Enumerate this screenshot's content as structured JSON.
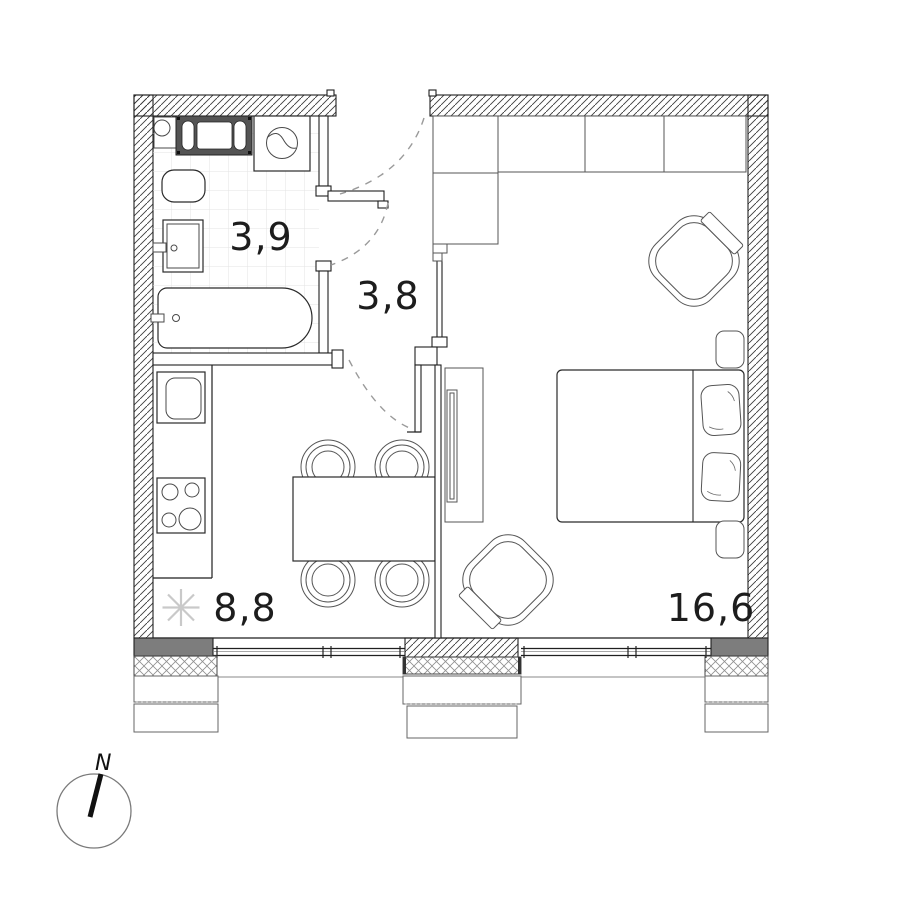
{
  "plan": {
    "rooms": [
      {
        "id": "bathroom",
        "area_label": "3,9"
      },
      {
        "id": "hallway",
        "area_label": "3,8"
      },
      {
        "id": "kitchen",
        "area_label": "8,8"
      },
      {
        "id": "living-room",
        "area_label": "16,6"
      }
    ],
    "compass": {
      "north_label": "N"
    },
    "colors": {
      "pier_fill": "#7d7d7d",
      "appliance_frame": "#545454",
      "snowflake": "#c9c9c9",
      "tile_line": "#e3e3e3",
      "dash_line": "#9a9a9a"
    }
  }
}
